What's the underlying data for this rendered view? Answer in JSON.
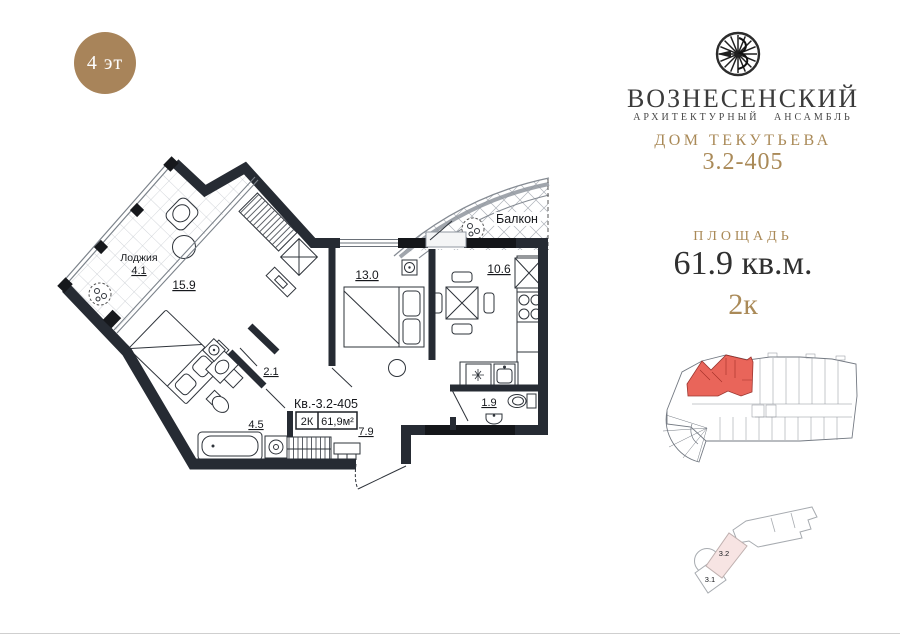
{
  "badge": {
    "floor": "4 эт"
  },
  "brand": {
    "name": "ВОЗНЕСЕНСКИЙ",
    "tagline": "АРХИТЕКТУРНЫЙ АНСАМБЛЬ",
    "house": "ДОМ ТЕКУТЬЕВА",
    "unit": "3.2-405"
  },
  "area": {
    "label": "ПЛОЩАДЬ",
    "value": "61.9 кв.м.",
    "rooms": "2к"
  },
  "plan": {
    "loggia_name": "Лоджия",
    "loggia_area": "4.1",
    "living_area": "15.9",
    "bedroom_area": "13.0",
    "kitchen_area": "10.6",
    "balcony_label": "Балкон",
    "hall_area": "2.1",
    "bath_area": "4.5",
    "wc_area": "1.9",
    "hallway_area": "7.9",
    "apartment_label": "Кв.-3.2-405",
    "spec_rooms": "2К",
    "spec_area": "61,9м²"
  },
  "site": {
    "section_highlight": "3.2",
    "section_other": "3.1"
  },
  "colors": {
    "gold": "#aa8a58",
    "badge_bg": "#a8845a",
    "wall": "#262b33",
    "apartment_red": "#e8584d",
    "section_pink": "#f7e4e3"
  }
}
